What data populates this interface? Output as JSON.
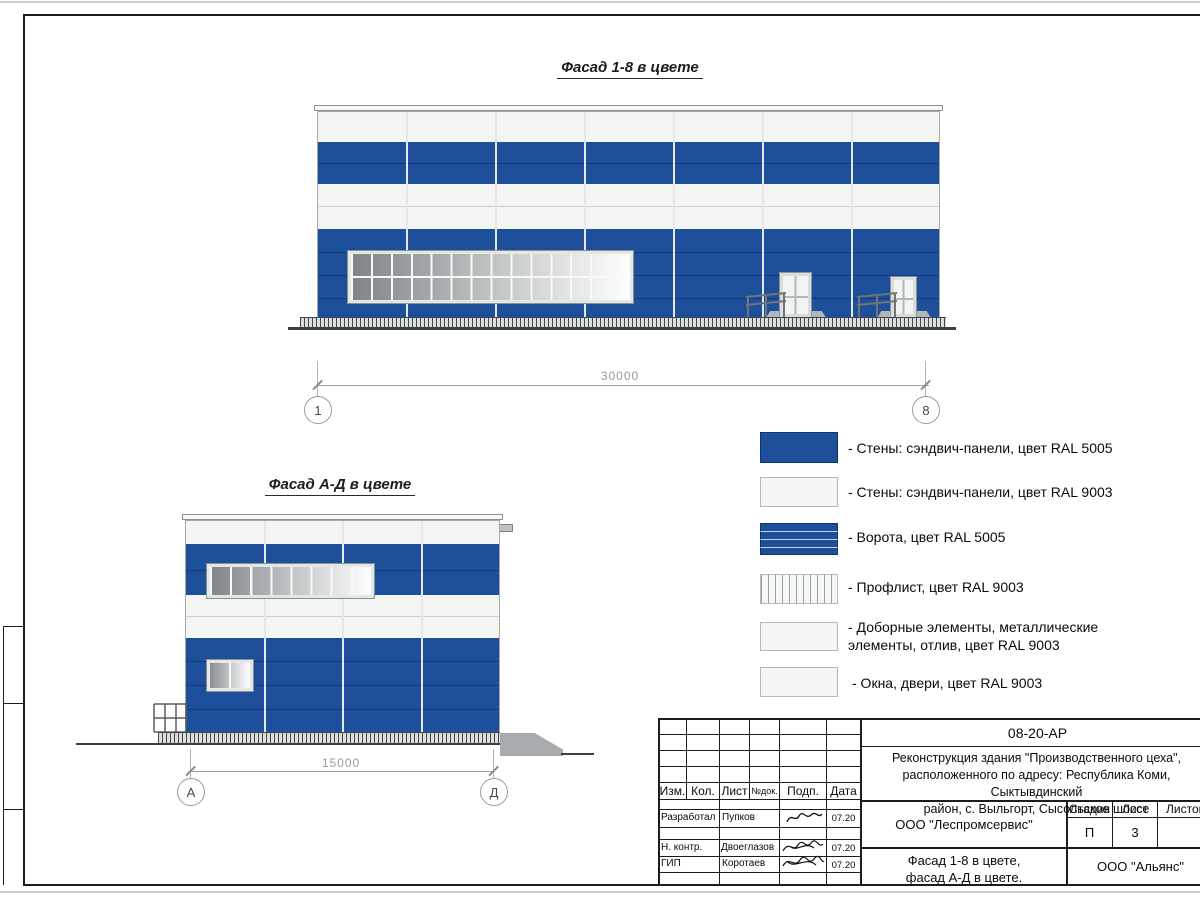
{
  "colors": {
    "ral5005_blue": "#1e4f9b",
    "ral9003_white": "#f3f5f2"
  },
  "facade_top": {
    "title": "Фасад 1-8 в цвете",
    "dim": "30000",
    "axis_left": "1",
    "axis_right": "8"
  },
  "facade_side": {
    "title": "Фасад А-Д в цвете",
    "dim": "15000",
    "axis_left": "А",
    "axis_right": "Д"
  },
  "legend": {
    "items": [
      {
        "swatch": "solid-blue",
        "label": "- Стены: сэндвич-панели, цвет RAL 5005"
      },
      {
        "swatch": "solid-white",
        "label": "- Стены: сэндвич-панели, цвет RAL 9003"
      },
      {
        "swatch": "blue-horizontal-lines",
        "label": "- Ворота, цвет RAL 5005"
      },
      {
        "swatch": "vertical-hatch",
        "label": "- Профлист, цвет RAL 9003"
      },
      {
        "swatch": "solid-white",
        "label": "- Доборные элементы, металлические\nэлементы, отлив, цвет RAL 9003"
      },
      {
        "swatch": "solid-white",
        "label": "- Окна, двери, цвет RAL 9003"
      }
    ]
  },
  "titleblock": {
    "doc_code": "08-20-АР",
    "project_line1": "Реконструкция здания \"Производственного цеха\",",
    "project_line2": "расположенного по адресу: Республика Коми, Сыктывдинский",
    "project_line3": "район, с. Выльгорт, Сысольское шоссе",
    "col_izm": "Изм.",
    "col_kol": "Кол.",
    "col_list": "Лист",
    "col_ndok": "№док.",
    "col_podp": "Подп.",
    "col_data": "Дата",
    "row1_role": "Разработал",
    "row1_name": "Пупков",
    "row1_date": "07.20",
    "row2_role": "Н. контр.",
    "row2_name": "Двоеглазов",
    "row2_date": "07.20",
    "row3_role": "ГИП",
    "row3_name": "Коротаев",
    "row3_date": "07.20",
    "org": "ООО \"Леспромсервис\"",
    "stage_label": "Стадия",
    "sheet_label": "Лист",
    "sheets_label": "Листов",
    "stage_value": "П",
    "sheet_value": "3",
    "title_line1": "Фасад 1-8 в цвете,",
    "title_line2": "фасад А-Д в цвете.",
    "firm": "ООО \"Альянс\""
  }
}
